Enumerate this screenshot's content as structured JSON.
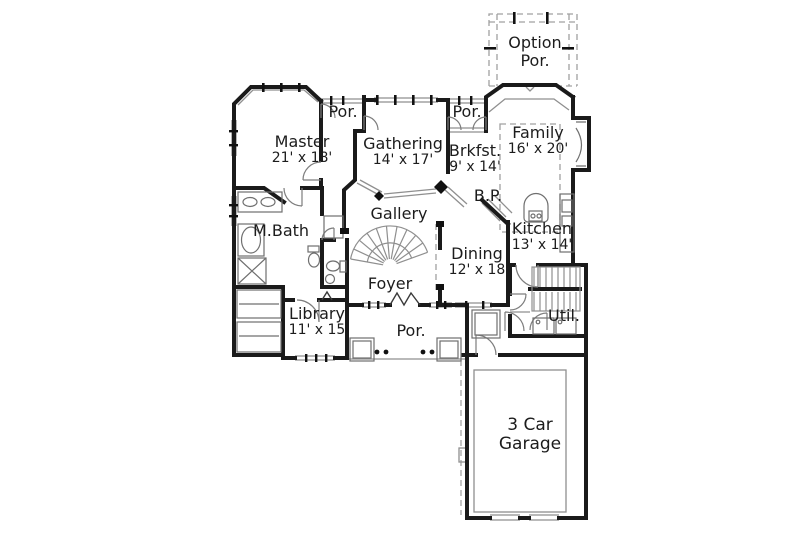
{
  "colors": {
    "background": "#ffffff",
    "walls": "#1a1a1a",
    "thin_lines": "#8f8f8f",
    "dashed_lines": "#a0a0a0",
    "text": "#1c1c1c"
  },
  "rooms": {
    "option_porch": {
      "line1": "Option",
      "line2": "Por."
    },
    "master": {
      "line1": "Master",
      "line2": "21' x 18'"
    },
    "porch_top_left": {
      "line1": "Por."
    },
    "gathering": {
      "line1": "Gathering",
      "line2": "14' x 17'"
    },
    "porch_top_right": {
      "line1": "Por."
    },
    "breakfast": {
      "line1": "Brkfst.",
      "line2": "9' x 14'"
    },
    "family": {
      "line1": "Family",
      "line2": "16' x 20'"
    },
    "gallery": {
      "line1": "Gallery"
    },
    "butlers_pantry": {
      "line1": "B.P."
    },
    "master_bath": {
      "line1": "M.Bath"
    },
    "kitchen": {
      "line1": "Kitchen",
      "line2": "13' x 14'"
    },
    "dining": {
      "line1": "Dining",
      "line2": "12' x 18"
    },
    "foyer": {
      "line1": "Foyer"
    },
    "library": {
      "line1": "Library",
      "line2": "11' x 15"
    },
    "porch_bottom": {
      "line1": "Por."
    },
    "utility": {
      "line1": "Util."
    },
    "garage": {
      "line1": "3 Car",
      "line2": "Garage"
    }
  }
}
